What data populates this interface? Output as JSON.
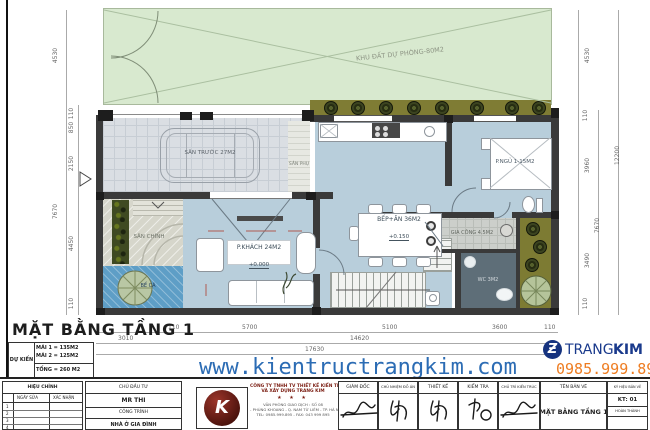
{
  "plan": {
    "title": "MẶT BẰNG TẦNG 1",
    "rooms": {
      "reserve": "KHU ĐẤT DỰ PHÒNG-80M2",
      "front_yard": "SÂN TRƯỚC 27M2",
      "aux_yard": "SÂN PHỤ",
      "main_yard": "SÂN CHÍNH",
      "fish_pond": "BỂ CÁ",
      "living": "P.KHÁCH 24M2",
      "living_level": "+0.000",
      "kitchen": "BẾP+ĂN 36M2",
      "kitchen_level": "+0.150",
      "bedroom": "P.NGỦ 1-15M2",
      "utility": "GIA CÔNG 4.5M2",
      "wc": "WC 3M2"
    },
    "dims": {
      "left": [
        "4530",
        "110",
        "850",
        "2150",
        "7670",
        "4450",
        "110"
      ],
      "right": [
        "4530",
        "110",
        "3960",
        "3490",
        "110",
        "7670",
        "12200"
      ],
      "bottom": [
        "110",
        "5700",
        "5100",
        "3600",
        "110",
        "3010",
        "14620",
        "17630"
      ]
    },
    "summary": {
      "label": "DỰ KIẾN",
      "row1": "MÁI 1 = 135M2",
      "row2": "MÁI 2 = 125M2",
      "row3": "TỔNG = 260 M2"
    }
  },
  "branding": {
    "website": "www.kientructrangkim.com",
    "brand_1": "TRANG",
    "brand_2": "KIM",
    "phone": "0985.999.895"
  },
  "titleblock": {
    "revision": {
      "header": "HIỆU CHỈNH",
      "col_date": "NGÀY SỬA",
      "col_confirm": "XÁC NHẬN",
      "rows": [
        "1",
        "2",
        "3",
        "4"
      ]
    },
    "client": {
      "header": "CHỦ ĐẦU TƯ",
      "name": "MR THI",
      "project_label": "CÔNG TRÌNH",
      "project_name": "NHÀ Ở GIA ĐÌNH"
    },
    "company": {
      "logo_letter": "K",
      "line1": "CÔNG TY TNHH TV THIẾT KẾ KIẾN TRÚC",
      "line2": "VÀ XÂY DỰNG TRANG KIM",
      "stars": "★ ★ ★",
      "addr1": "VĂN PHÒNG GIAO DỊCH : SỐ 08",
      "addr2": "- PHÙNG KHOANG - Q. NAM TỪ LIÊM - TP. HÀ NỘI",
      "addr3": "TEL: 0985.999.895 - FAX: 043 999 895"
    },
    "signatures": [
      {
        "role": "GIÁM ĐỐC"
      },
      {
        "role": "CHỦ NHIỆM ĐỒ ÁN"
      },
      {
        "role": "THIẾT KẾ"
      },
      {
        "role": "KIỂM TRA"
      },
      {
        "role": "CHỦ TRÌ KIẾN TRÚC"
      }
    ],
    "drawing": {
      "header": "TÊN BẢN VẼ",
      "name": "MẶT BẰNG TẦNG 1"
    },
    "code": {
      "header": "KÝ HIỆU BẢN VẼ",
      "value": "KT: 01",
      "status": "HOÀN THÀNH"
    }
  }
}
